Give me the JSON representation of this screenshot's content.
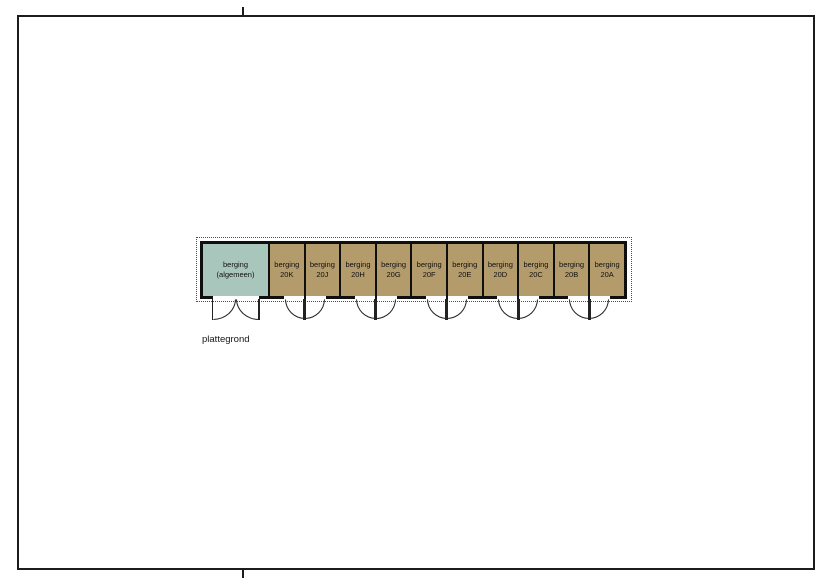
{
  "drawing": {
    "caption": "plattegrond"
  },
  "colors": {
    "general": "#a9c6bc",
    "unit": "#b49b6c",
    "wall": "#0f0f0f"
  },
  "rooms": [
    {
      "line1": "berging",
      "line2": "(algemeen)",
      "type": "general",
      "door": "double-outswing"
    },
    {
      "line1": "berging",
      "line2": "20K",
      "type": "unit",
      "door": "single-outswing-hinge-right"
    },
    {
      "line1": "berging",
      "line2": "20J",
      "type": "unit",
      "door": "single-outswing-hinge-left"
    },
    {
      "line1": "berging",
      "line2": "20H",
      "type": "unit",
      "door": "single-outswing-hinge-right"
    },
    {
      "line1": "berging",
      "line2": "20G",
      "type": "unit",
      "door": "single-outswing-hinge-left"
    },
    {
      "line1": "berging",
      "line2": "20F",
      "type": "unit",
      "door": "single-outswing-hinge-right"
    },
    {
      "line1": "berging",
      "line2": "20E",
      "type": "unit",
      "door": "single-outswing-hinge-left"
    },
    {
      "line1": "berging",
      "line2": "20D",
      "type": "unit",
      "door": "single-outswing-hinge-right"
    },
    {
      "line1": "berging",
      "line2": "20C",
      "type": "unit",
      "door": "single-outswing-hinge-left"
    },
    {
      "line1": "berging",
      "line2": "20B",
      "type": "unit",
      "door": "single-outswing-hinge-right"
    },
    {
      "line1": "berging",
      "line2": "20A",
      "type": "unit",
      "door": "single-outswing-hinge-left"
    }
  ]
}
